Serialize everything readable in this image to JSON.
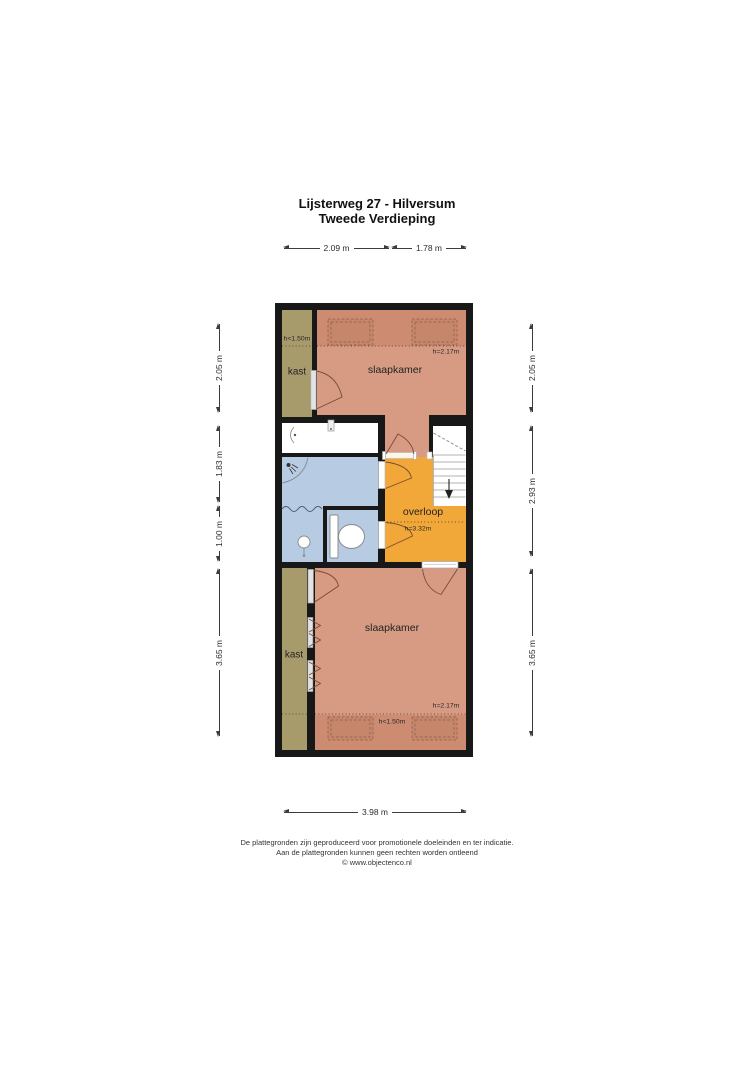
{
  "title": {
    "line1": "Lijsterweg 27 - Hilversum",
    "line2": "Tweede Verdieping"
  },
  "plan": {
    "rooms": {
      "kast_top": {
        "label": "kast",
        "height_note": "h<1.50m"
      },
      "slaapkamer_top": {
        "label": "slaapkamer",
        "height_note": "h=2.17m"
      },
      "overloop": {
        "label": "overloop",
        "height_note": "h=3.32m"
      },
      "kast_bottom": {
        "label": "kast"
      },
      "slaapkamer_bottom": {
        "label": "slaapkamer",
        "height_note": "h=2.17m",
        "height_note_low": "h<1.50m"
      }
    }
  },
  "dims": {
    "top": [
      {
        "label": "2.09 m"
      },
      {
        "label": "1.78 m"
      }
    ],
    "left": [
      {
        "label": "2.05 m"
      },
      {
        "label": "1.83 m"
      },
      {
        "label": "1.00 m"
      },
      {
        "label": "3.65 m"
      }
    ],
    "right": [
      {
        "label": "2.05 m"
      },
      {
        "label": "2.93 m"
      },
      {
        "label": "3.65 m"
      }
    ],
    "bottom": [
      {
        "label": "3.98 m"
      }
    ]
  },
  "footer": {
    "line1": "De plattegronden zijn geproduceerd voor promotionele doeleinden en ter indicatie.",
    "line2": "Aan de plattegronden kunnen geen rechten worden ontleend",
    "line3": "© www.objectenco.nl"
  },
  "colors": {
    "wall": "#181818",
    "salmon": "#d69b82",
    "salmon-dark": "#cd8c72",
    "olive": "#a89b6b",
    "blue": "#b7cbe3",
    "orange": "#f2a838"
  }
}
